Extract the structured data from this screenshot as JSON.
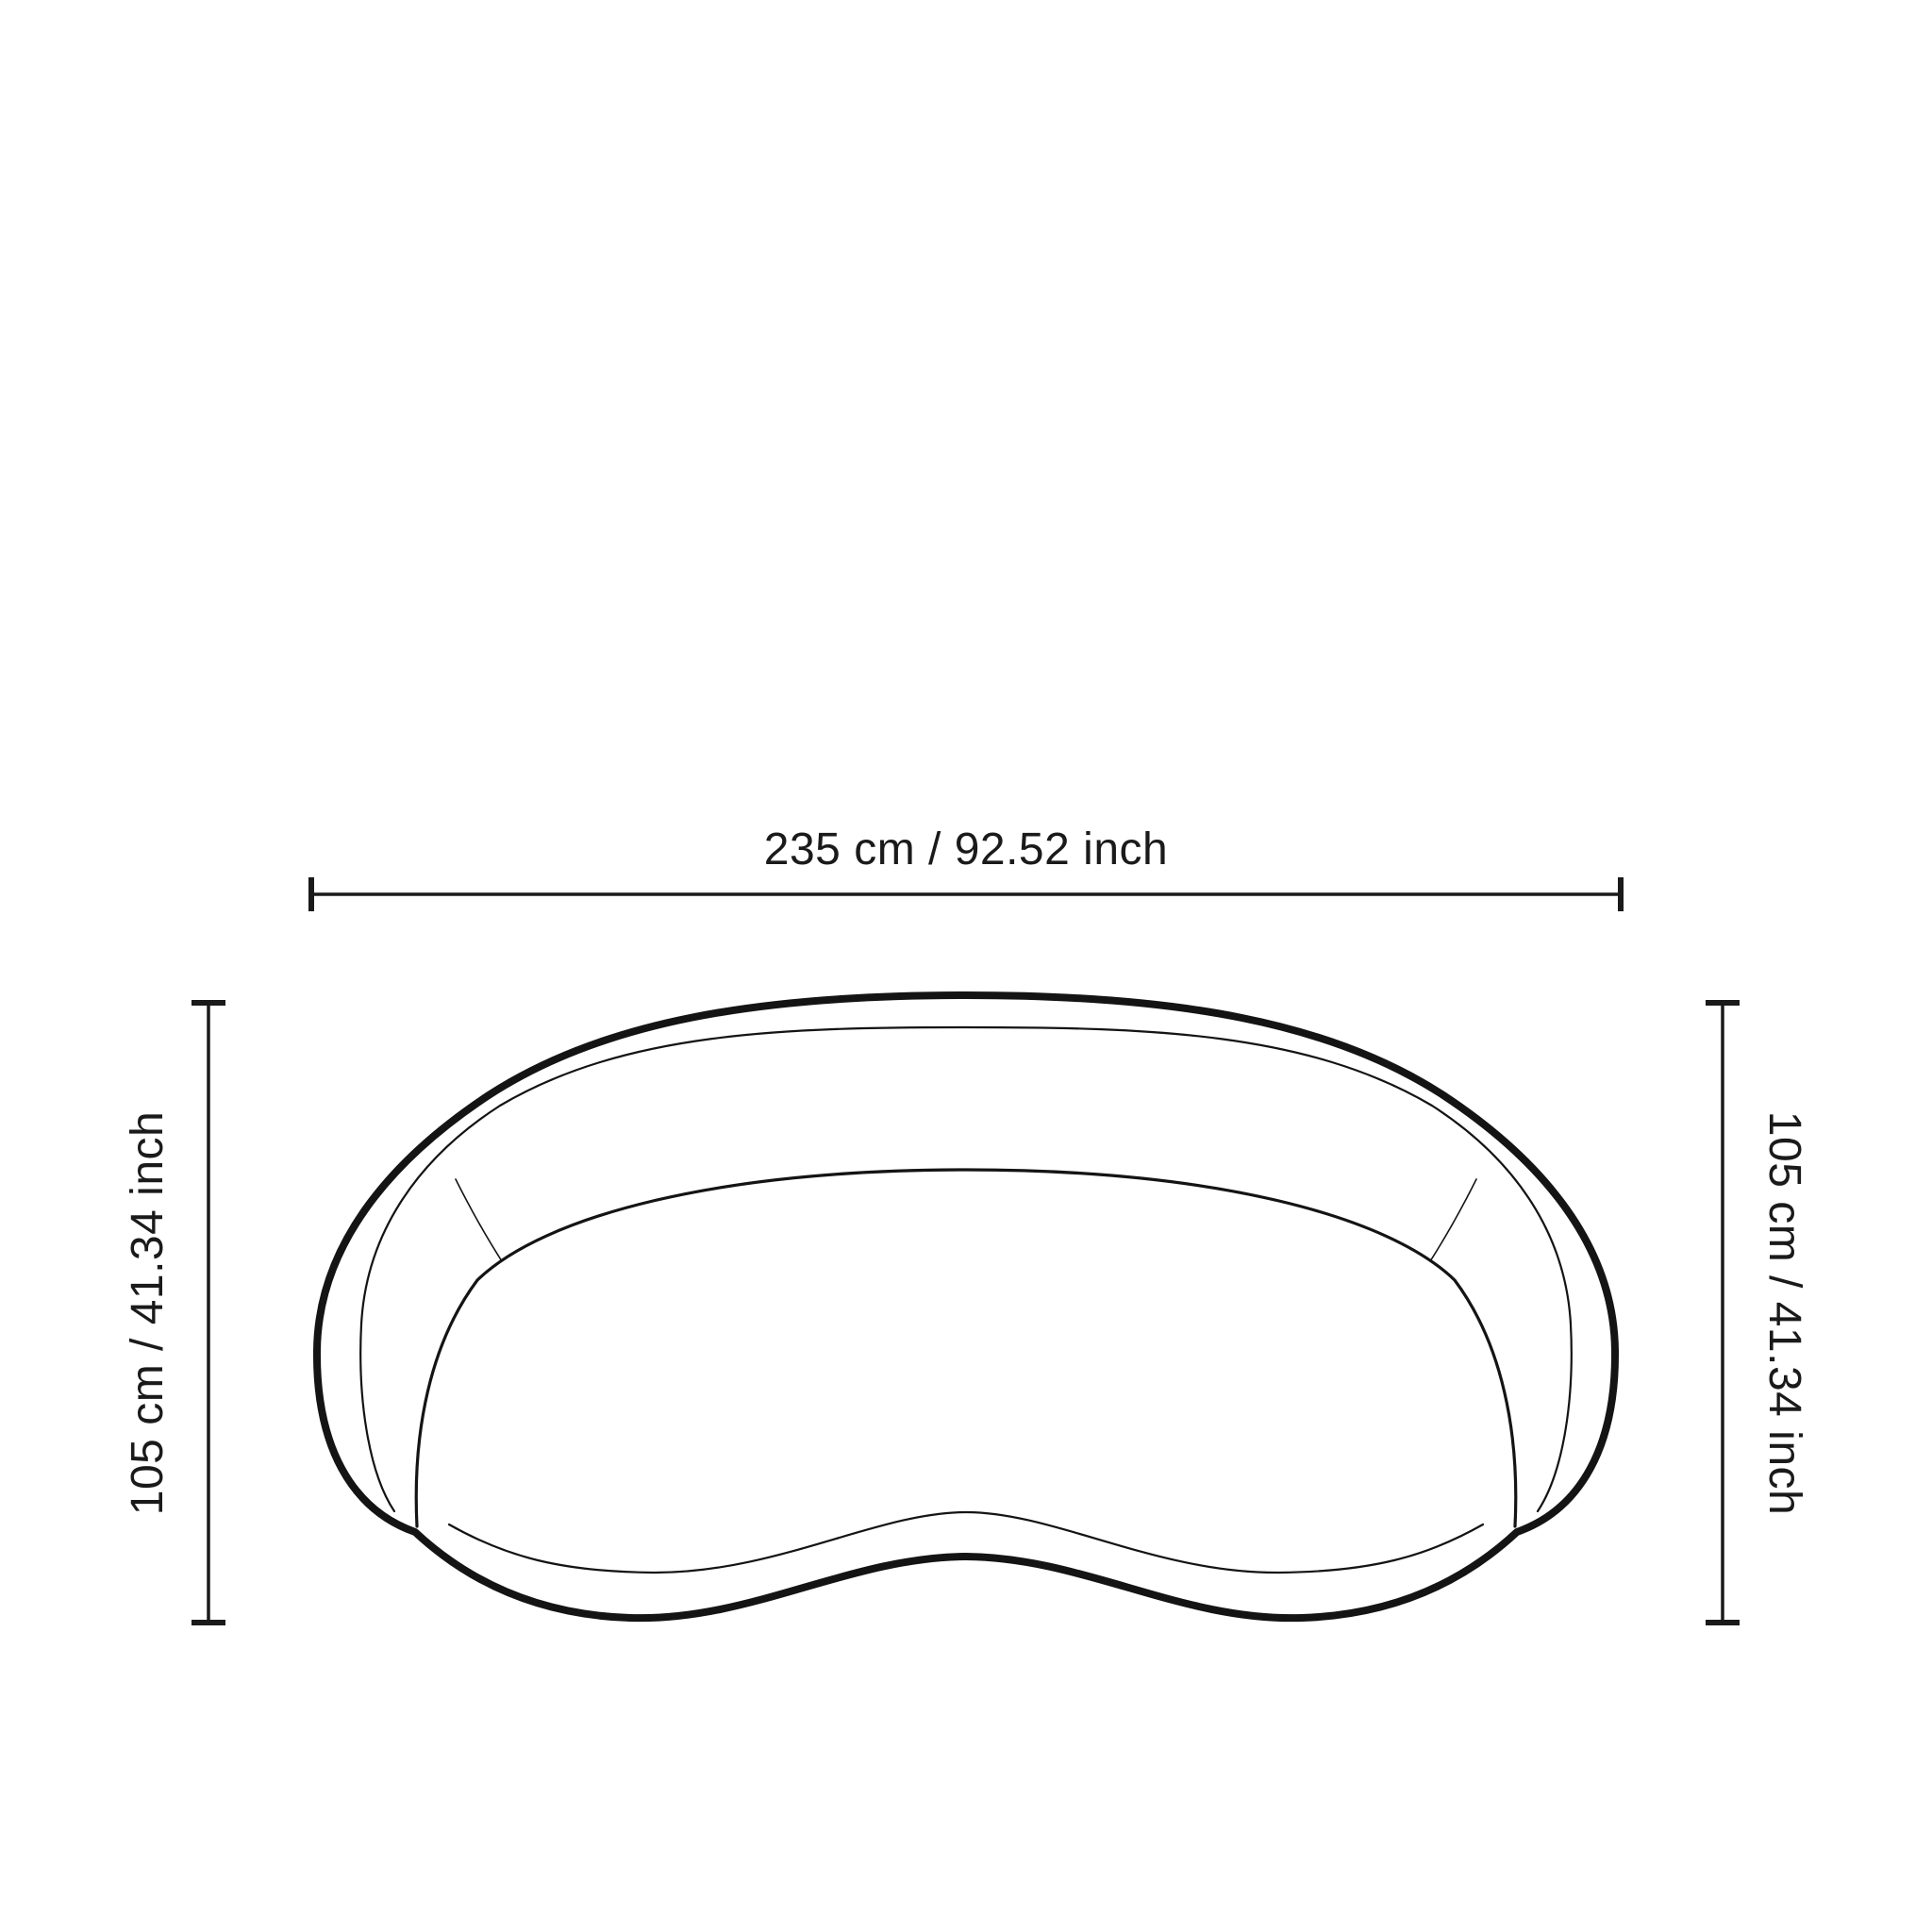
{
  "diagram": {
    "subject": "curved-kidney-sofa-top-view",
    "background_color": "#ffffff",
    "line_color": "#1a1a1a"
  },
  "dimensions": {
    "width": {
      "label": "235 cm / 92.52 inch",
      "cm": "235",
      "inch": "92.52"
    },
    "depth_left": {
      "label": "105 cm / 41.34 inch",
      "cm": "105",
      "inch": "41.34"
    },
    "depth_right": {
      "label": "105 cm / 41.34 inch",
      "cm": "105",
      "inch": "41.34"
    }
  }
}
